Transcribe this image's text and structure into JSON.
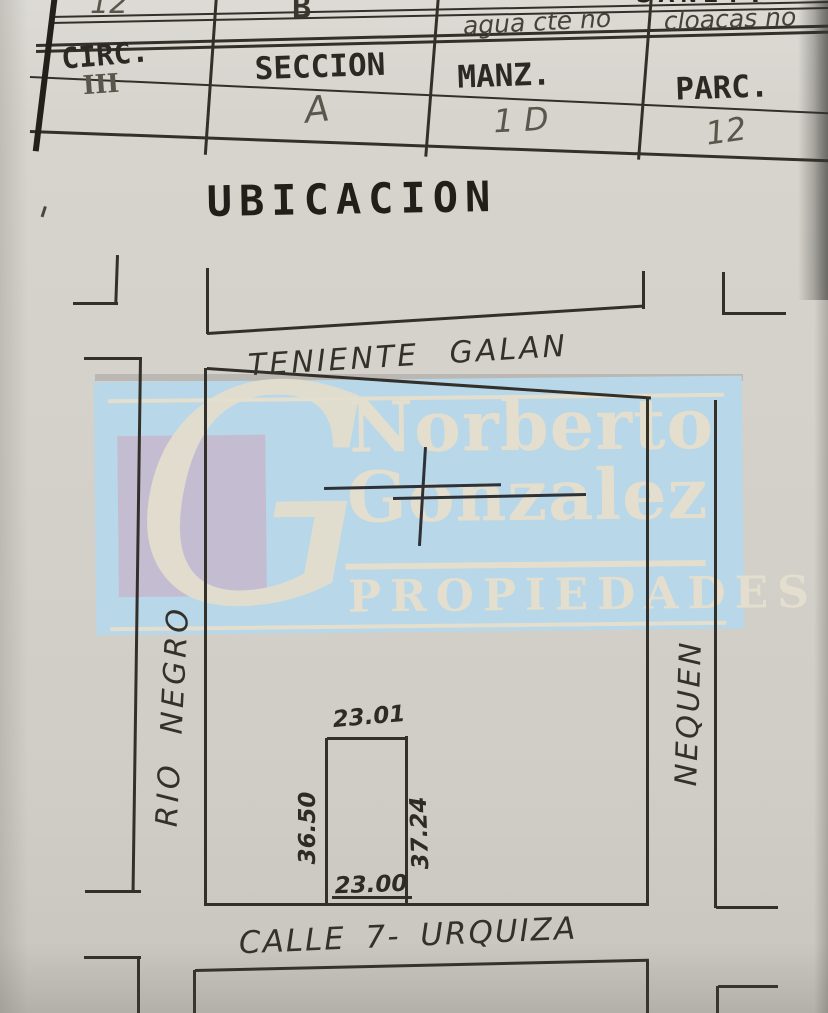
{
  "document": {
    "table": {
      "clipped_row": {
        "circ_value": "12",
        "seccion_value": "B",
        "agua": "agua cte no",
        "cloacas": "cloacas no",
        "clipped_top_label": "SANIT."
      },
      "headers": [
        "CIRC.",
        "SECCION",
        "MANZ.",
        "PARC."
      ],
      "values": [
        "III",
        "A",
        "1 D",
        "12"
      ]
    },
    "title": "UBICACION",
    "map": {
      "street_top": "TENIENTE GALAN",
      "street_left": "RIO NEGRO",
      "street_right": "NEQUEN",
      "street_bottom": "CALLE 7- URQUIZA",
      "parcel": {
        "width_top": "23.01",
        "depth_left": "36.50",
        "depth_right": "37.24",
        "width_bottom": "23.00"
      }
    },
    "watermark": {
      "monogram": "G",
      "name_line1": "Norberto",
      "name_line2": "Gonzalez",
      "subtitle": "PROPIEDADES"
    },
    "colors": {
      "paper": "#d5d3cc",
      "ink": "#33302a",
      "pencil": "#5a564c",
      "watermark_blue": "#b8d7e8",
      "watermark_lavender": "#c4bdd2",
      "watermark_cream": "#e3decd"
    }
  }
}
